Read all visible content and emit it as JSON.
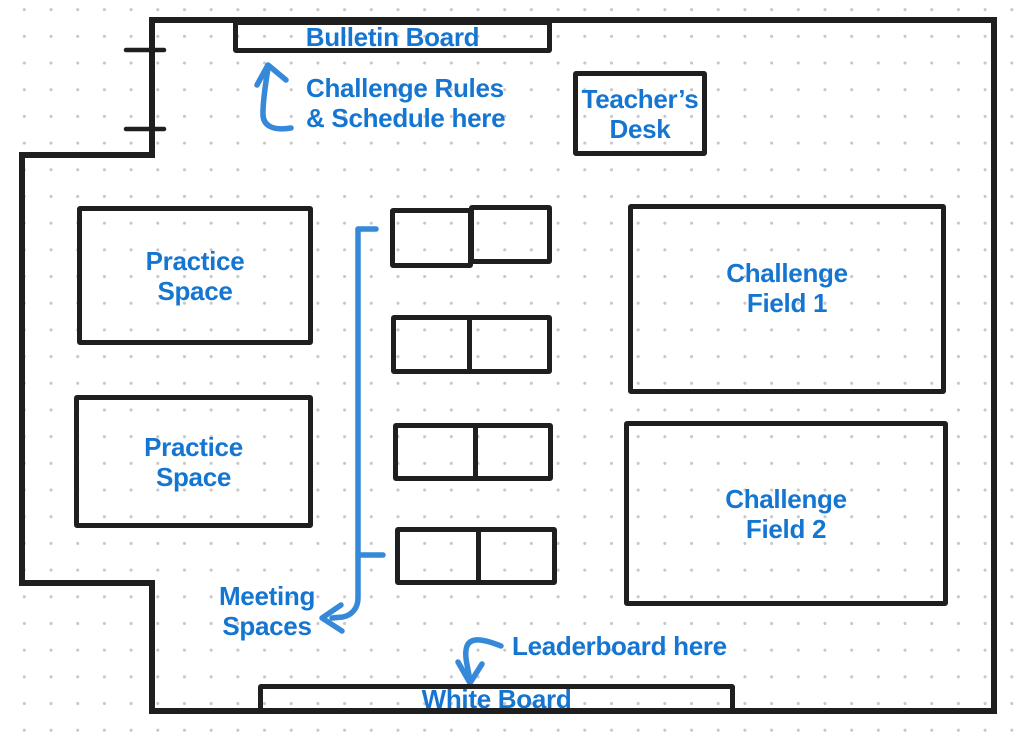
{
  "colors": {
    "label_blue": "#1576d2",
    "arrow_blue": "#3688d8",
    "wall_black": "#1f1f1f",
    "grid_dot": "#c8c8c8",
    "background": "#ffffff"
  },
  "areas": {
    "bulletin_board": {
      "label": "Bulletin Board"
    },
    "teachers_desk": {
      "line1": "Teacher’s",
      "line2": "Desk"
    },
    "practice_space_top": {
      "line1": "Practice",
      "line2": "Space"
    },
    "practice_space_bottom": {
      "line1": "Practice",
      "line2": "Space"
    },
    "challenge_field_1": {
      "line1": "Challenge",
      "line2": "Field 1"
    },
    "challenge_field_2": {
      "line1": "Challenge",
      "line2": "Field 2"
    },
    "white_board": {
      "label": "White Board"
    }
  },
  "annotations": {
    "rules_note": {
      "line1": "Challenge Rules",
      "line2": "& Schedule here"
    },
    "meeting_note": {
      "line1": "Meeting",
      "line2": "Spaces"
    },
    "leaderboard_note": {
      "label": "Leaderboard here"
    }
  }
}
